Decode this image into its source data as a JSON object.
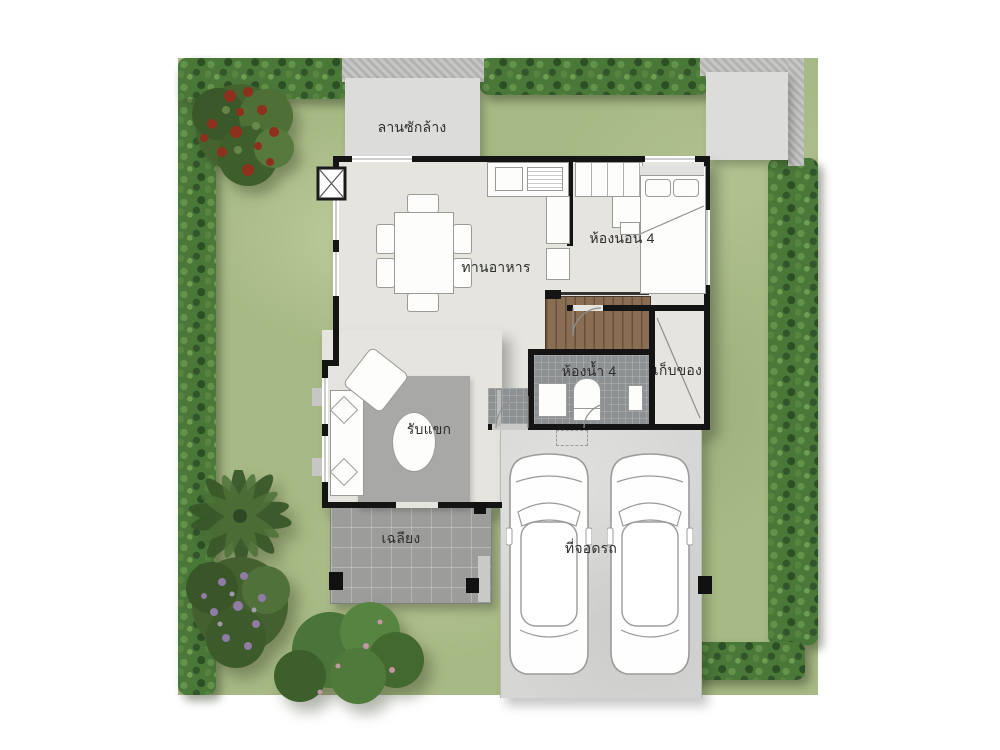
{
  "meta": {
    "type": "house floor plan, top view architectural rendering",
    "floors_shown": 1,
    "vehicles_in_parking": 2
  },
  "labels": {
    "washing_area": "ลานซักล้าง",
    "dining_room": "ทานอาหาร",
    "bedroom_4": "ห้องนอน 4",
    "bathroom_4": "ห้องน้ำ 4",
    "storage_room": "เก็บของ",
    "living_room": "รับแขก",
    "porch": "เฉลียง",
    "parking": "ที่จอดรถ"
  },
  "site": {
    "vegetation": [
      "hedge-border",
      "red-flowering-tree-top-left",
      "palm-tree-bottom-left",
      "purple-flower-shrub-bottom-left",
      "green-bushes-bottom"
    ],
    "hardscape": [
      "washing-pad-top",
      "concrete-pad-top-right",
      "driveway-bottom-right",
      "porch-bottom-left"
    ]
  },
  "colors": {
    "lawn": "#a7b984",
    "hedge": "#4a7839",
    "floor": "#e5e4de",
    "wall": "#141414",
    "porch_tile": "#9c9c9a",
    "bath_tile": "#8d9193",
    "stair_wood": "#8a6e54",
    "driveway": "#d6d6d4",
    "pad": "#dcdcda",
    "tree_flower_red": "#8f2f1d",
    "shrub_flower_purple": "#8f7ba6",
    "label_text": "#2d2d2d"
  }
}
